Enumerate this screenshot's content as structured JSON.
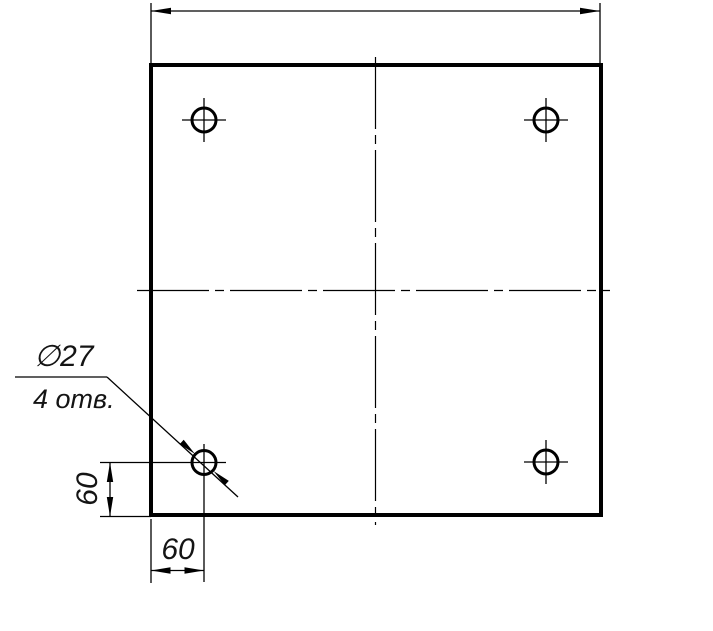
{
  "drawing": {
    "type": "technical-drawing",
    "title": "Square plate with four drilled holes",
    "colors": {
      "line": "#000000",
      "background": "#ffffff",
      "text": "#141414"
    },
    "labels": {
      "hole_diameter": "∅27",
      "hole_count_note": "4 отв.",
      "offset_left_vertical": "60",
      "offset_bottom_horizontal": "60"
    },
    "values": {
      "hole_diameter_mm": 27,
      "number_of_holes": 4,
      "hole_offset_from_left_mm": 60,
      "hole_offset_from_bottom_mm": 60
    }
  }
}
